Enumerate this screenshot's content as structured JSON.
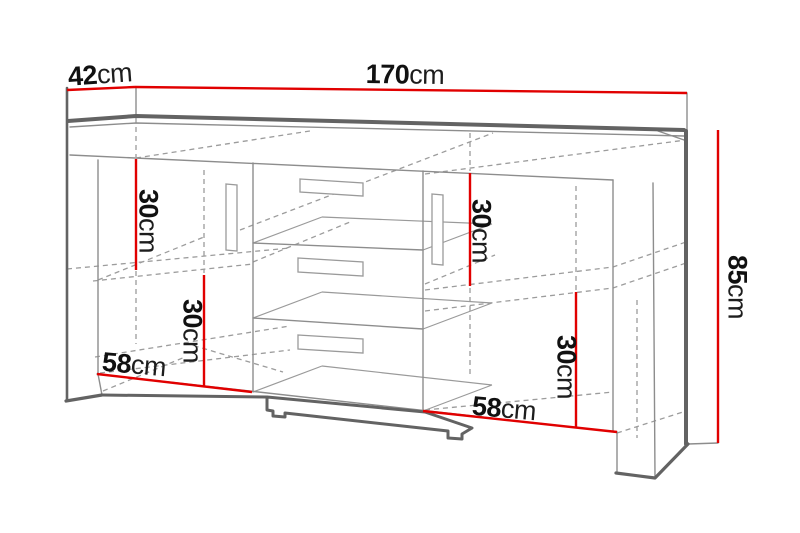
{
  "diagram": {
    "kind": "furniture dimension drawing",
    "product": "sideboard with two doors and three central drawers",
    "unit": "cm",
    "overall_dimensions": {
      "width_cm": 170,
      "depth_cm": 42,
      "height_cm": 85
    },
    "internal_dimensions": {
      "left_upper_compartment_height_cm": 30,
      "right_upper_compartment_height_cm": 30,
      "left_lower_compartment_height_cm": 30,
      "right_lower_compartment_height_cm": 30,
      "left_compartment_width_cm": 58,
      "right_compartment_width_cm": 58
    },
    "colors": {
      "dimension_line": "#e10000",
      "outline_thick": "#636363",
      "outline_thin": "#8d8d8d",
      "hidden_edge_dashed": "#9c9c9c",
      "label_text": "#111111",
      "background": "#ffffff"
    },
    "labels": [
      {
        "name": "width",
        "value": "170",
        "unit": "cm"
      },
      {
        "name": "depth",
        "value": "42",
        "unit": "cm"
      },
      {
        "name": "height",
        "value": "85",
        "unit": "cm"
      },
      {
        "name": "left-upper-compartment",
        "value": "30",
        "unit": "cm"
      },
      {
        "name": "right-upper-compartment",
        "value": "30",
        "unit": "cm"
      },
      {
        "name": "left-lower-compartment",
        "value": "30",
        "unit": "cm"
      },
      {
        "name": "right-lower-compartment",
        "value": "30",
        "unit": "cm"
      },
      {
        "name": "left-compartment-width",
        "value": "58",
        "unit": "cm"
      },
      {
        "name": "right-compartment-width",
        "value": "58",
        "unit": "cm"
      }
    ]
  }
}
